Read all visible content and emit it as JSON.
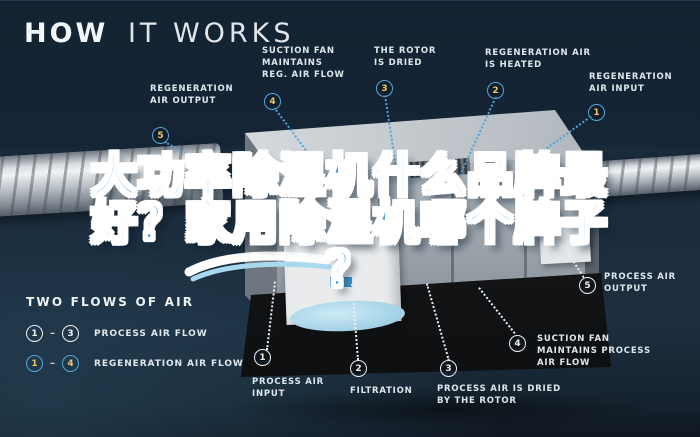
{
  "header": {
    "title_bold": "HOW",
    "title_light": "IT WORKS"
  },
  "headline": {
    "line1": "大功率除湿机什么品牌最",
    "line2": "好？家用除湿机哪个牌子",
    "line3": "？"
  },
  "legend": {
    "title": "TWO FLOWS OF AIR",
    "rows": [
      {
        "from": "1",
        "dash": "–",
        "to": "3",
        "label": "PROCESS AIR FLOW",
        "flow": "process"
      },
      {
        "from": "1",
        "dash": "–",
        "to": "4",
        "label": "REGENERATION AIR FLOW",
        "flow": "regeneration"
      }
    ]
  },
  "callouts": [
    {
      "num": "5",
      "label": "REGENERATION\nAIR OUTPUT",
      "flow": "regeneration"
    },
    {
      "num": "4",
      "label": "SUCTION FAN\nMAINTAINS\nREG. AIR FLOW",
      "flow": "regeneration"
    },
    {
      "num": "3",
      "label": "THE ROTOR\nIS DRIED",
      "flow": "regeneration"
    },
    {
      "num": "2",
      "label": "REGENERATION AIR\nIS HEATED",
      "flow": "regeneration"
    },
    {
      "num": "1",
      "label": "REGENERATION\nAIR INPUT",
      "flow": "regeneration"
    },
    {
      "num": "5",
      "label": "PROCESS AIR\nOUTPUT",
      "flow": "process"
    },
    {
      "num": "4",
      "label": "SUCTION FAN\nMAINTAINS PROCESS\nAIR FLOW",
      "flow": "process"
    },
    {
      "num": "3",
      "label": "PROCESS AIR IS DRIED\nBY THE ROTOR",
      "flow": "process"
    },
    {
      "num": "2",
      "label": "FILTRATION",
      "flow": "process"
    },
    {
      "num": "1",
      "label": "PROCESS AIR\nINPUT",
      "flow": "process"
    }
  ],
  "colors": {
    "background": "#152536",
    "accent_blue": "#4ea4d6",
    "badge_number_yellow": "#ebc76a",
    "label_text": "#dfe7ec",
    "headline_blue": "#2e8fd2",
    "headline_outline": "#ffffff"
  }
}
